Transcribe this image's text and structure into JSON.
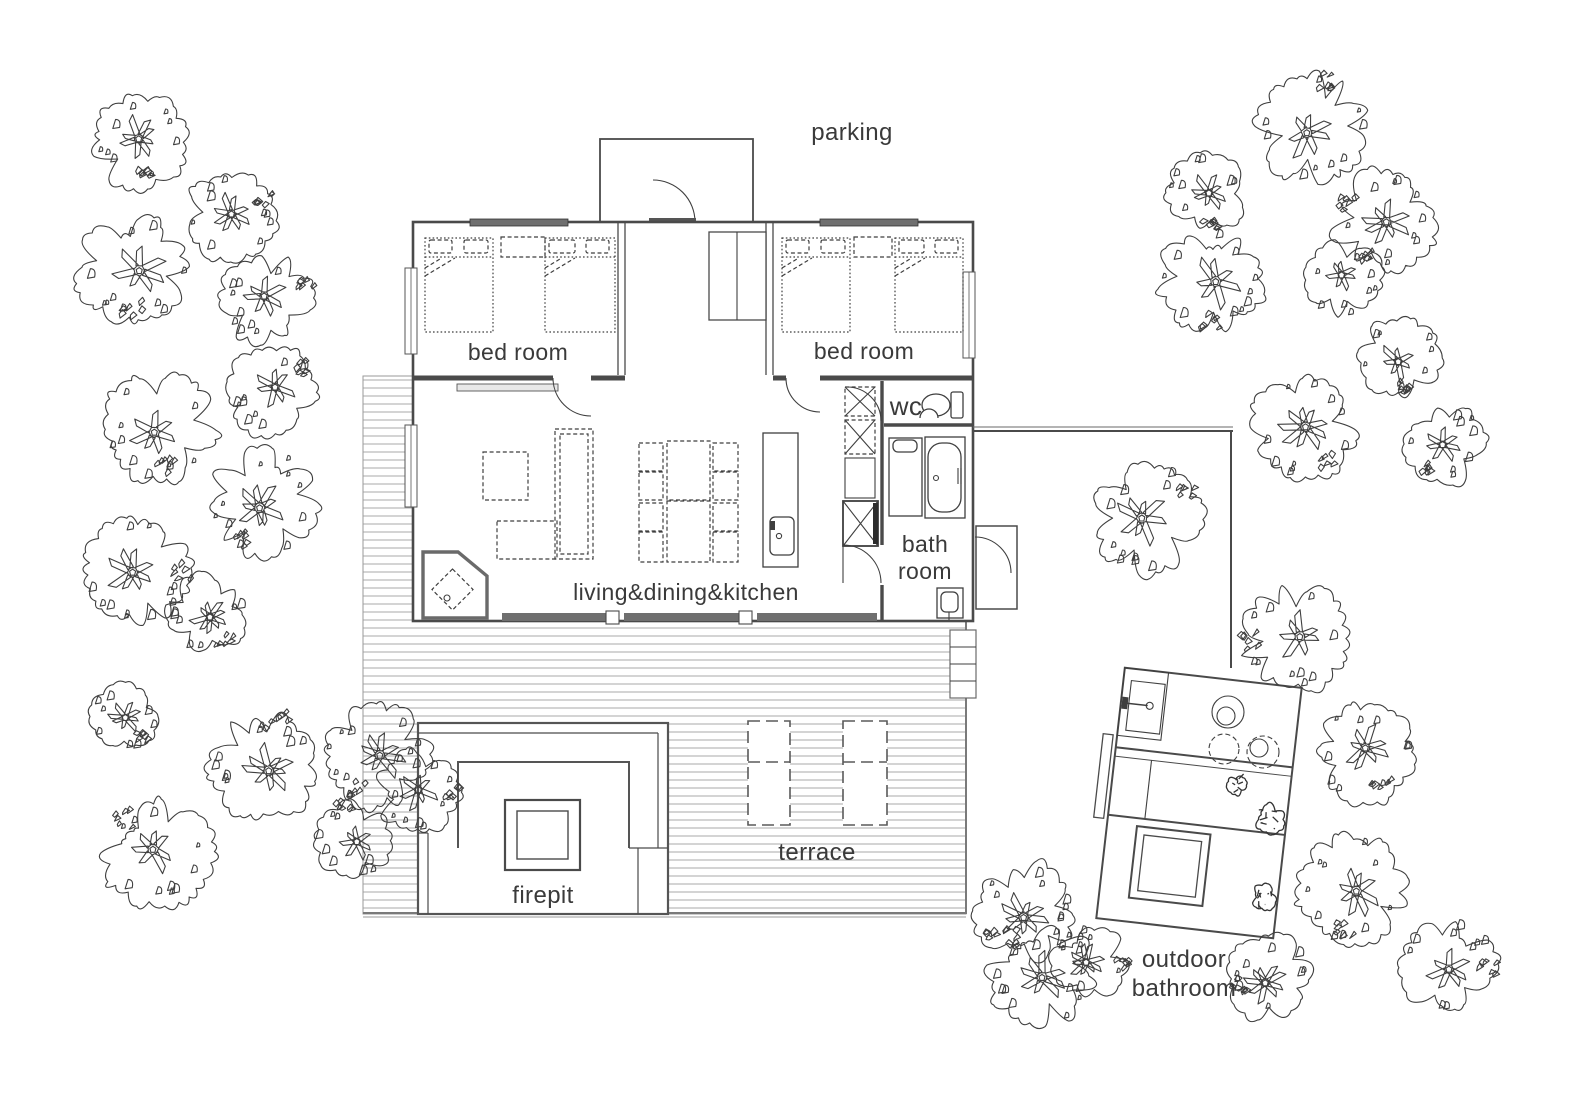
{
  "title": "cabin site floor plan",
  "colors": {
    "ink": "#3f3f3f",
    "wall": "#4a4a4a",
    "deck_line": "#a8a8a8",
    "window_band": "#6f6f6f",
    "text": "#3a3a3a"
  },
  "labels": {
    "parking": "parking",
    "bedroom_left": "bed room",
    "bedroom_right": "bed room",
    "living": "living&dining&kitchen",
    "wc": "wc",
    "bath_line1": "bath",
    "bath_line2": "room",
    "terrace": "terrace",
    "firepit": "firepit",
    "outdoor_line1": "outdoor",
    "outdoor_line2": "bathroom"
  },
  "trees": [
    {
      "x": 141,
      "y": 142,
      "r": 49
    },
    {
      "x": 230,
      "y": 218,
      "r": 46
    },
    {
      "x": 133,
      "y": 268,
      "r": 58
    },
    {
      "x": 267,
      "y": 300,
      "r": 48
    },
    {
      "x": 272,
      "y": 390,
      "r": 46
    },
    {
      "x": 160,
      "y": 427,
      "r": 57
    },
    {
      "x": 263,
      "y": 503,
      "r": 57
    },
    {
      "x": 137,
      "y": 570,
      "r": 55
    },
    {
      "x": 207,
      "y": 614,
      "r": 42
    },
    {
      "x": 125,
      "y": 717,
      "r": 36
    },
    {
      "x": 263,
      "y": 765,
      "r": 55
    },
    {
      "x": 375,
      "y": 755,
      "r": 54
    },
    {
      "x": 417,
      "y": 792,
      "r": 44
    },
    {
      "x": 353,
      "y": 840,
      "r": 40
    },
    {
      "x": 157,
      "y": 853,
      "r": 57
    },
    {
      "x": 1313,
      "y": 127,
      "r": 57
    },
    {
      "x": 1207,
      "y": 193,
      "r": 41
    },
    {
      "x": 1383,
      "y": 220,
      "r": 52
    },
    {
      "x": 1212,
      "y": 281,
      "r": 56
    },
    {
      "x": 1343,
      "y": 279,
      "r": 40
    },
    {
      "x": 1400,
      "y": 357,
      "r": 43
    },
    {
      "x": 1303,
      "y": 428,
      "r": 54
    },
    {
      "x": 1445,
      "y": 444,
      "r": 41
    },
    {
      "x": 1147,
      "y": 518,
      "r": 57
    },
    {
      "x": 1295,
      "y": 637,
      "r": 56
    },
    {
      "x": 1365,
      "y": 753,
      "r": 50
    },
    {
      "x": 1352,
      "y": 890,
      "r": 56
    },
    {
      "x": 1270,
      "y": 978,
      "r": 45
    },
    {
      "x": 1448,
      "y": 966,
      "r": 49
    },
    {
      "x": 1090,
      "y": 964,
      "r": 40
    },
    {
      "x": 1025,
      "y": 913,
      "r": 53
    },
    {
      "x": 1040,
      "y": 974,
      "r": 55
    }
  ],
  "shrubs": [
    {
      "x": 1237,
      "y": 785,
      "r": 11
    },
    {
      "x": 1269,
      "y": 819,
      "r": 16
    },
    {
      "x": 1264,
      "y": 897,
      "r": 14
    }
  ]
}
